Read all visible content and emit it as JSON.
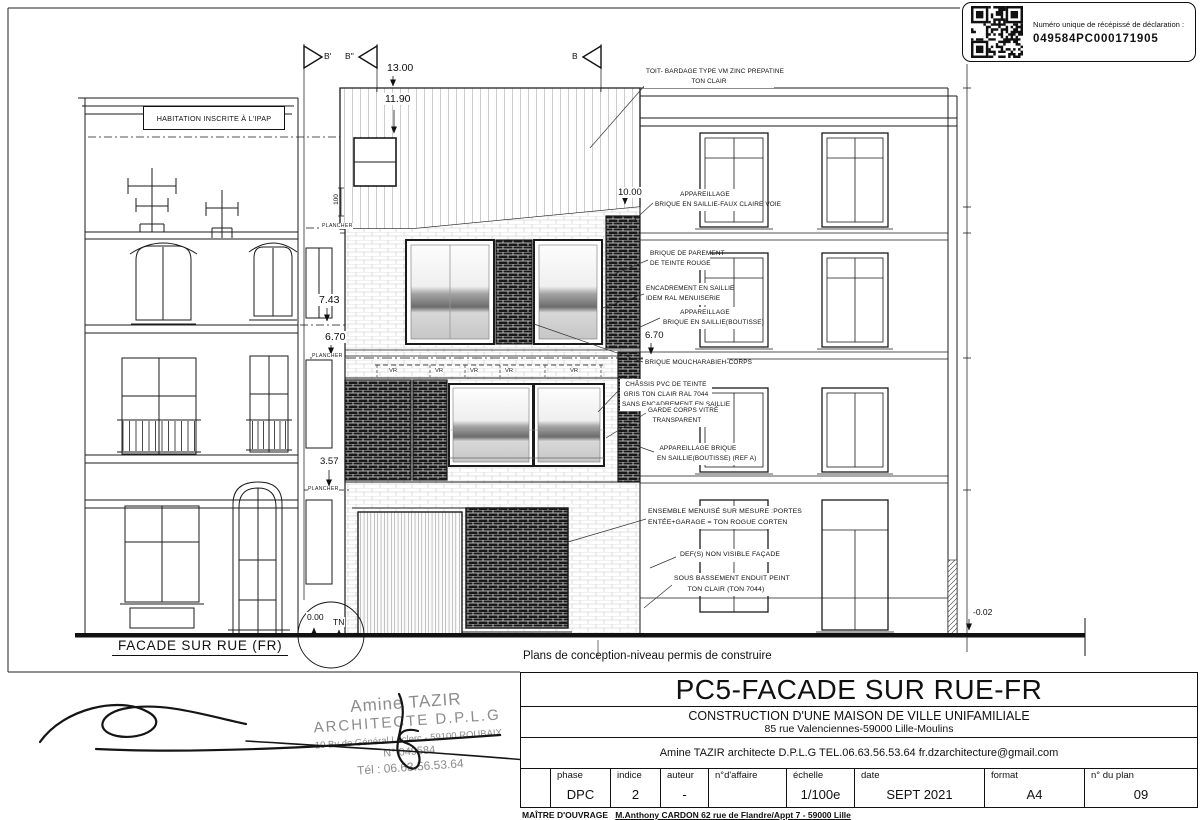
{
  "colors": {
    "ink": "#1a1a1a",
    "stamp_gray": "#8c8c8c"
  },
  "receipt": {
    "label": "Numéro unique de récépissé de déclaration :",
    "number": "049584PC000171905"
  },
  "drawing": {
    "left_building_label": "HABITATION INSCRITE À L'IPAP",
    "facade_caption": "FACADE SUR RUE (FR)",
    "section_markers": {
      "b_prime": "B'",
      "b_second": "B''",
      "b": "B"
    },
    "levels": {
      "d13": "13.00",
      "d119": "11.90",
      "d100": "100",
      "d10": "10.00",
      "d743": "7.43",
      "d67_left": "6.70",
      "d67_right": "6.70",
      "d357": "3.57",
      "d0": "0.00",
      "tn": "TN",
      "dm002": "-0.02"
    },
    "plancher": "PLANCHER",
    "vr": "VR",
    "annotations": [
      {
        "lines": [
          "TOIT- BARDAGE TYPE VM ZINC PREPATINE",
          "TON CLAIR"
        ]
      },
      {
        "lines": [
          "APPAREILLAGE",
          "BRIQUE EN SAILLIE-FAUX CLAIRE VOIE"
        ]
      },
      {
        "lines": [
          "BRIQUE DE PAREMENT",
          "DE TEINTE ROUGE"
        ]
      },
      {
        "lines": [
          "ENCADREMENT EN SAILLIE",
          "IDEM RAL MENUISERIE"
        ]
      },
      {
        "lines": [
          "APPAREILLAGE",
          "BRIQUE EN SAILLIE(BOUTISSE)"
        ]
      },
      {
        "lines": [
          "BRIQUE MOUCHARABIEH-CORPS"
        ]
      },
      {
        "lines": [
          "CHÂSSIS PVC DE TEINTE",
          "GRIS TON CLAIR RAL 7044",
          "SANS ENCADREMENT EN SAILLIE"
        ]
      },
      {
        "lines": [
          "GARDE CORPS VITRÉ",
          "TRANSPARENT"
        ]
      },
      {
        "lines": [
          "APPAREILLAGE BRIQUE",
          "EN SAILLIE(BOUTISSE) (REF A)"
        ]
      },
      {
        "lines": [
          "ENSEMBLE MENUISÉ SUR MESURE :PORTES",
          "ENTÉE+GARAGE = TON ROGUE CORTEN"
        ]
      },
      {
        "lines": [
          "DEF(S) NON VISIBLE FAÇADE"
        ]
      },
      {
        "lines": [
          "SOUS BASSEMENT ENDUIT PEINT",
          "TON CLAIR (TON 7044)"
        ]
      }
    ]
  },
  "caption": "Plans de conception-niveau permis de construire",
  "title_block": {
    "title": "PC5-FACADE SUR RUE-FR",
    "project": "CONSTRUCTION D'UNE MAISON DE VILLE UNIFAMILIALE",
    "address": "85 rue Valenciennes-59000 Lille-Moulins",
    "architect": "Amine TAZIR architecte D.P.L.G  TEL.06.63.56.53.64  fr.dzarchitecture@gmail.com",
    "cells": [
      {
        "label": "phase",
        "value": "DPC"
      },
      {
        "label": "indice",
        "value": "2"
      },
      {
        "label": "auteur",
        "value": "-"
      },
      {
        "label": "n°d'affaire",
        "value": ""
      },
      {
        "label": "échelle",
        "value": "1/100e"
      },
      {
        "label": "date",
        "value": "SEPT 2021"
      },
      {
        "label": "format",
        "value": "A4"
      },
      {
        "label": "n° du plan",
        "value": "09"
      }
    ]
  },
  "stamp": {
    "name": "Amine TAZIR",
    "title": "ARCHITECTE   D.P.L.G",
    "address": "10 Bv de Général Leclerc - 59100 ROUBAIX",
    "number": "N° 049584",
    "phone": "Tél : 06.63.56.53.64"
  },
  "footer": {
    "label": "MAÎTRE D'OUVRAGE",
    "value": "M.Anthony CARDON 62 rue de Flandre/Appt 7 - 59000 Lille"
  }
}
